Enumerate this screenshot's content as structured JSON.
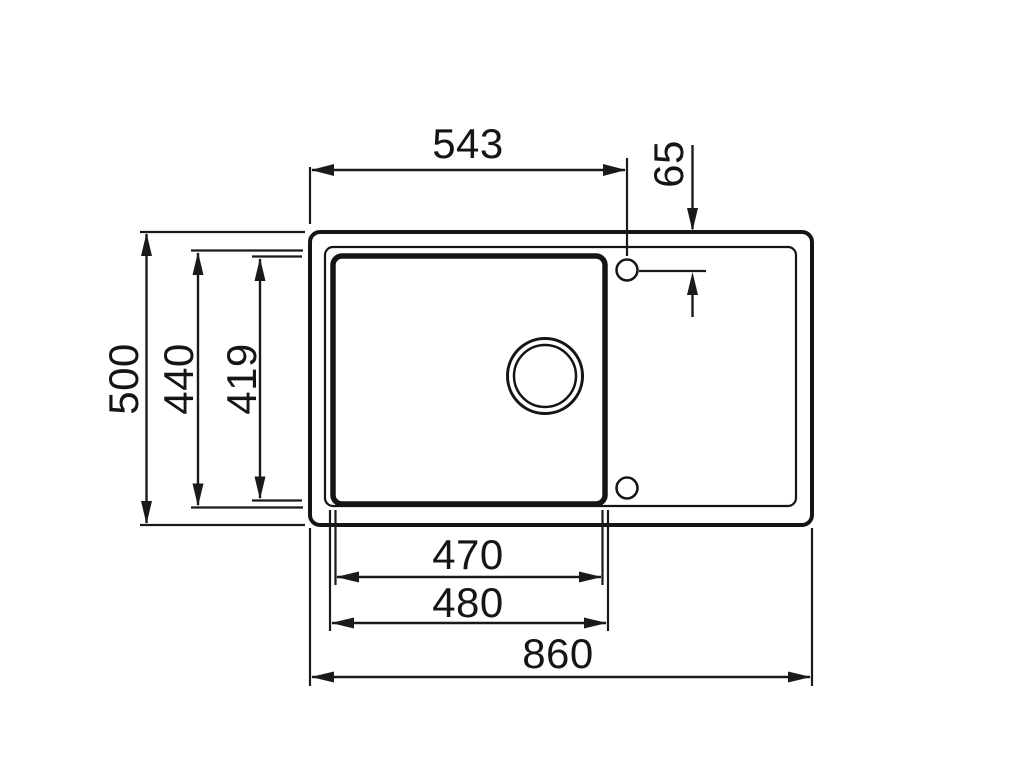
{
  "drawing": {
    "type": "sink-top-view-dimension-drawing",
    "line_color": "#151515",
    "background_color": "#ffffff",
    "dims": {
      "hole_offset_x": "543",
      "hole_offset_y": "65",
      "overall_depth": "500",
      "bowl_outer_depth": "440",
      "bowl_inner_depth": "419",
      "bowl_inner_width": "470",
      "bowl_outer_width": "480",
      "overall_width": "860"
    }
  }
}
